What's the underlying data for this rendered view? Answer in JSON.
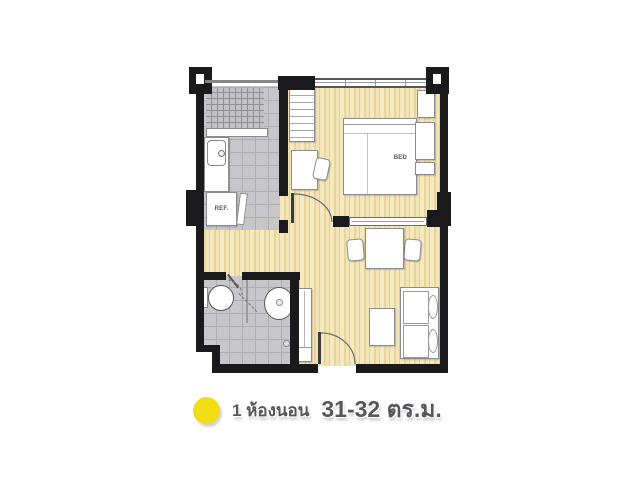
{
  "plan": {
    "labels": {
      "bed": "BED",
      "ref": "REF."
    },
    "colors": {
      "wall": "#1a1a1c",
      "wood_floor": "#eedcaa",
      "tile_floor": "#c7c7c9",
      "furniture": "#ffffff"
    }
  },
  "caption": {
    "bullet_color": "#f2de17",
    "line1": "1 ห้องนอน",
    "line2": "31-32 ตร.ม."
  }
}
